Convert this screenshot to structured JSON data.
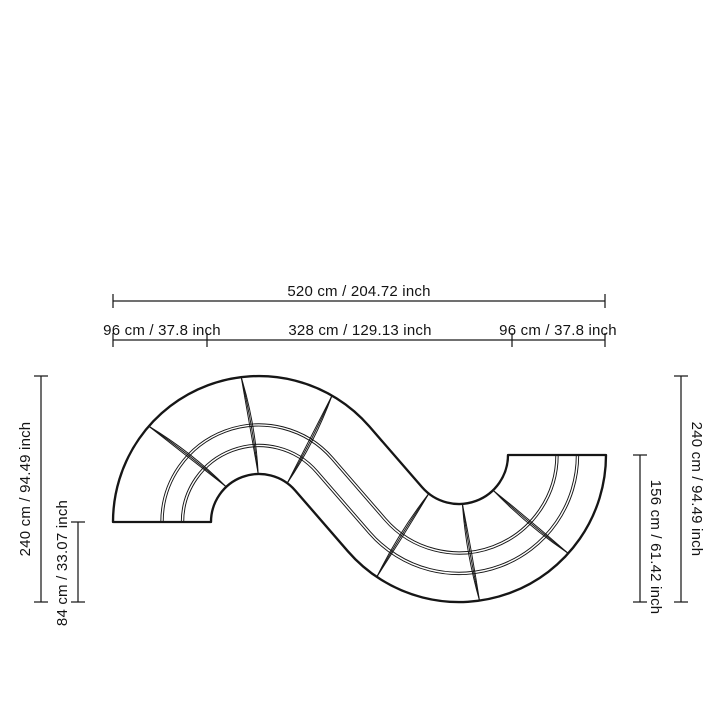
{
  "diagram": {
    "background": "#ffffff",
    "line_color": "#1a1a1a",
    "sofa_line_color": "#161616",
    "text_color": "#131313"
  },
  "dimensions": {
    "overall_width": "520 cm / 204.72 inch",
    "left_module_width": "96 cm / 37.8 inch",
    "middle_section_width": "328 cm / 129.13 inch",
    "right_module_width": "96 cm / 37.8 inch",
    "left_overall_depth": "240 cm / 94.49 inch",
    "left_end_depth": "84 cm / 33.07 inch",
    "right_overall_depth": "240 cm / 94.49 inch",
    "right_end_depth": "156 cm / 61.42 inch"
  }
}
